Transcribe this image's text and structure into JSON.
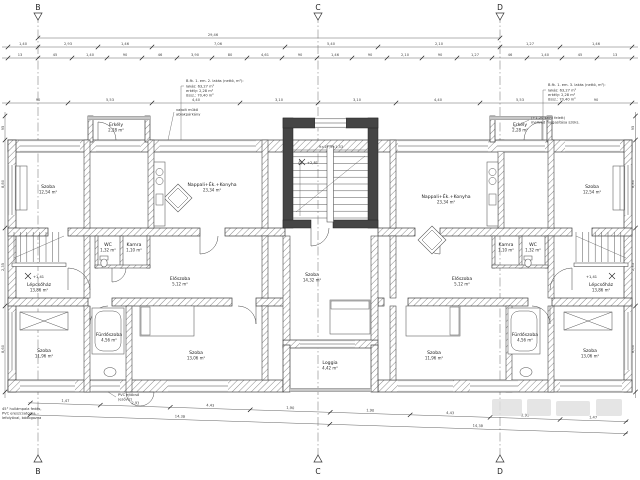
{
  "sections": {
    "b": "B",
    "c": "C",
    "d": "D"
  },
  "dims": {
    "total": "29,46",
    "top1": [
      "1,40",
      "2,93",
      "1,46",
      "7,06",
      "5,40",
      "2,10",
      "1,27",
      "1,46"
    ],
    "top2": [
      "13",
      "45",
      "1,40",
      "90",
      "46",
      "3,90",
      "80",
      "4,61",
      "90",
      "1,46",
      "90",
      "2,10",
      "90",
      "1,27",
      "46",
      "1,40",
      "45",
      "13"
    ],
    "mid": [
      "90",
      "5,53",
      "4,40",
      "3,10",
      "3,10",
      "4,40",
      "5,53",
      "90"
    ],
    "bottom1": [
      "1,47",
      "2,93",
      "4,43",
      "1,90",
      "1,90",
      "4,43",
      "2,93",
      "1,47"
    ],
    "bottom2": [
      "14,38",
      "14,38"
    ],
    "left": [
      "95",
      "8,80",
      "2,35",
      "8,60"
    ],
    "right": [
      "95",
      "8,80",
      "2,35",
      "8,60"
    ],
    "stair_spec": "9×17,5=1,53"
  },
  "levels": {
    "stair_center": "+2,81",
    "stair_left": "+1,41",
    "stair_right": "+1,41"
  },
  "rooms": {
    "erkely_left": {
      "name": "Erkély",
      "area": "2,28 m²"
    },
    "erkely_right": {
      "name": "Erkély",
      "area": "2,28 m²"
    },
    "szoba_tl": {
      "name": "Szoba",
      "area": "12,54 m²"
    },
    "szoba_tr": {
      "name": "Szoba",
      "area": "12,54 m²"
    },
    "nappali_left": {
      "name": "Nappali+Ék.+Konyha",
      "area": "23,34 m²"
    },
    "nappali_right": {
      "name": "Nappali+Ék.+Konyha",
      "area": "23,34 m²"
    },
    "wc_left": {
      "name": "WC",
      "area": "1,32 m²"
    },
    "wc_right": {
      "name": "WC",
      "area": "1,32 m²"
    },
    "kamra_left": {
      "name": "Kamra",
      "area": "1,10 m²"
    },
    "kamra_right": {
      "name": "Kamra",
      "area": "1,10 m²"
    },
    "eloszoba_left": {
      "name": "Előszoba",
      "area": "5,12 m²"
    },
    "eloszoba_right": {
      "name": "Előszoba",
      "area": "5,12 m²"
    },
    "lepcsohaz_left": {
      "name": "Lépcsőház",
      "area": "13,86 m²"
    },
    "lepcsohaz_right": {
      "name": "Lépcsőház",
      "area": "13,86 m²"
    },
    "szoba_bl": {
      "name": "Szoba",
      "area": "11,96 m²"
    },
    "szoba_br": {
      "name": "Szoba",
      "area": "11,96 m²"
    },
    "furdo_left": {
      "name": "Fürdőszoba",
      "area": "4,56 m²"
    },
    "furdo_right": {
      "name": "Fürdőszoba",
      "area": "4,56 m²"
    },
    "szoba_bl2": {
      "name": "Szoba",
      "area": "13,06 m²"
    },
    "szoba_br2": {
      "name": "Szoba",
      "area": "13,06 m²"
    },
    "szoba_center": {
      "name": "Szoba",
      "area": "14,32 m²"
    },
    "loggia": {
      "name": "Loggia",
      "area": "4,42 m²"
    }
  },
  "annotations": {
    "apt_left": {
      "title": "B.fk. 1. em. 2. lakás (nettó, m²):",
      "l1": "lakás:  63,27 m²",
      "l2": "erkély:  2,28 m²",
      "l3": "össz.:  70,40 m²"
    },
    "apt_right": {
      "title": "B.fk. 1. em. 3. lakás (nettó, m²):",
      "l1": "lakás:  63,27 m²",
      "l2": "erkély:  2,28 m²",
      "l3": "össz.:  70,40 m²"
    },
    "balcony_note1": "(+1,20 szint felett)",
    "balcony_note2": "mellvéd magasítása szüks.",
    "parkany1": "vakolt műkő",
    "parkany2": "ablakpárkány",
    "eresz1": "45° hullámpala fedés,",
    "eresz2": "PVC ereszcsatorna,",
    "eresz3": "lefolyóval, bádogozva",
    "pvc1": "PVC ejtőcső",
    "pvc2": "(esővíz)"
  }
}
